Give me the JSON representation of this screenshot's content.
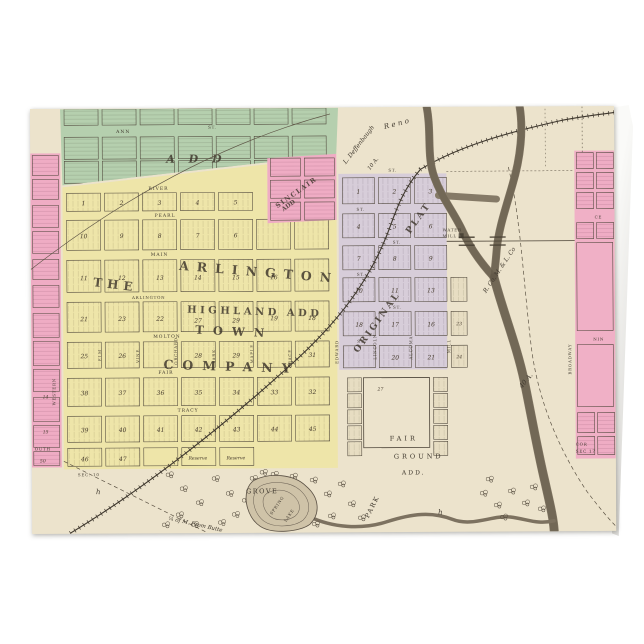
{
  "page": {
    "background": "#ffffff"
  },
  "card": {
    "kind": "folded greeting card mockup",
    "paper": "#ece3cc"
  },
  "m": {
    "colors": {
      "paper": "#ece3cc",
      "green": "#b5cfae",
      "yellow": "#eee5a9",
      "pink": "#efacc4",
      "lavender": "#d7cdd9",
      "cream_block": "#e7ddc2",
      "ink": "#3f382e",
      "river": "#8a7e6a"
    },
    "adds": {
      "west": "A D D",
      "sinclair1": "SINCLAIR",
      "sinclair2": "ADD",
      "the": "THE",
      "arlington": "ARLINGTON",
      "town": "TOWN",
      "company": "COMPANY",
      "highland": "HIGHLAND ADD",
      "original1": "ORIGINAL",
      "original2": "PLAT",
      "fg1": "FAIR",
      "fg2": "GROUND",
      "fg3": "ADD."
    },
    "st": {
      "ann": "ANN",
      "st": "ST.",
      "river": "RIVER",
      "pearl": "PEARL",
      "main": "MAIN",
      "arlington": "ARLINGTON",
      "molton": "MOLTON",
      "fair": "FAIR",
      "tracy": "TRACY",
      "western": "WESTERN",
      "elm": "ELM",
      "vine": "VINE",
      "orchard": "ORCHARD",
      "park": "PARK",
      "maple": "MAPLE",
      "race": "RACE",
      "edward": "EDWARD",
      "lincoln": "LINCOLN",
      "alcoma": "ALCOMA",
      "mill": "MILL",
      "broadway": "BROADWAY",
      "south": "OUTH",
      "ce": "CE",
      "nin": "NIN"
    },
    "ann": {
      "deff": "L. Deffenbaugh",
      "tena": "10 A.",
      "reno": "Reno",
      "rr": "R. Co. M. & L. Co",
      "fortya": "40 A.",
      "wm1": "WATER",
      "wm2": "MILL",
      "grove": "GROVE",
      "spring": "SPRING",
      "lake": "LAKE",
      "park": "PARK",
      "sec10": "SEC. 10",
      "cor": "COR",
      "sec17": "SEC 17",
      "qtr": "¼ of M. From Butte",
      "res1": "Reserve",
      "res2": "Reserve",
      "h": "h"
    },
    "n": {
      "yA": [
        "1",
        "2",
        "3",
        "4",
        "5"
      ],
      "yB": [
        "10",
        "9",
        "8",
        "7",
        "6"
      ],
      "yC": [
        "11",
        "12",
        "13",
        "14",
        "15",
        "16"
      ],
      "yD": [
        "21",
        "23",
        "22",
        "27",
        "29",
        "19",
        "18"
      ],
      "yE": [
        "25",
        "26",
        "28",
        "29",
        "31"
      ],
      "yF": [
        "38",
        "37",
        "36",
        "35",
        "34",
        "33",
        "32"
      ],
      "yG": [
        "39",
        "40",
        "41",
        "42",
        "43",
        "44",
        "45"
      ],
      "yH": [
        "46",
        "47"
      ],
      "l1": [
        "1",
        "2",
        "3"
      ],
      "l2": [
        "4",
        "5",
        "6"
      ],
      "l3": [
        "7",
        "8",
        "9"
      ],
      "l4": [
        "10",
        "11",
        "13"
      ],
      "l5": [
        "18",
        "17",
        "16"
      ],
      "l6": [
        "20",
        "21"
      ],
      "lr": [
        "23",
        "24",
        "27"
      ],
      "pk": [
        "14",
        "15",
        "50"
      ]
    }
  }
}
